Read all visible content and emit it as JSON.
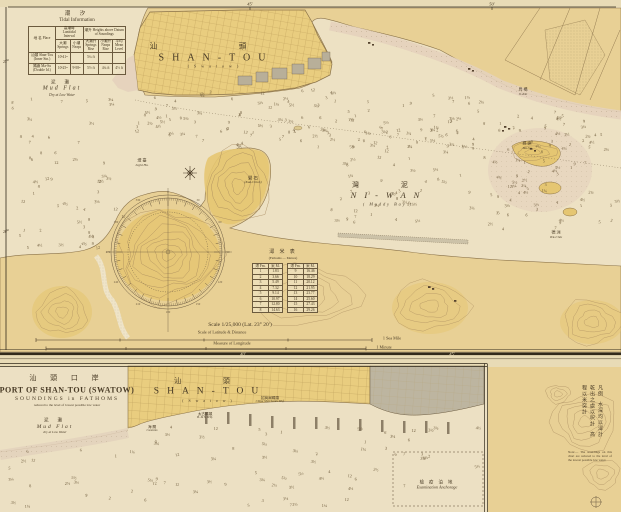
{
  "chart_title": "PORT OF SHAN-TOU (SWATOW)",
  "colors": {
    "paper": "#e8dbb6",
    "water": "#ede1c3",
    "land": "#e8d095",
    "city": "#e9cd7f",
    "hills": "#e5c672",
    "gray_block": "#b8af99",
    "tidal_flat": "#e5d3be",
    "ink": "#4a3b26",
    "contour": "#a88b5c",
    "border": "#332b1c"
  },
  "main_chart": {
    "top_ticks": [
      "45′",
      "50′"
    ],
    "left_ticks": [
      "25′",
      "20′"
    ],
    "bottom_ticks": [
      "40′",
      "45′"
    ],
    "tidal_table": {
      "title_cn": "潮 汐",
      "title_en": "Tidal Information",
      "name_header": "地 名 Place",
      "group1": "高潮時 Lunitidal Interval",
      "group2": "潮升 Heights above Datum of Soundings",
      "sub_headers": [
        "大潮 Springs",
        "小潮 Neaps",
        "大潮升 Springs Rise",
        "小潮升 Neaps Rise",
        "平均 Mean Level"
      ],
      "rows": [
        [
          "汕頭 Shan-Tou (Inner Stn.)",
          "10ʰ41ᵐ",
          "",
          "5¼ ft",
          "",
          ""
        ],
        [
          "媽嶼 Ma-Su (Double Id.)",
          "10ʰ25ᵐ",
          "9ʰ58ᵐ",
          "5½ ft",
          "4¼ ft",
          "4½ ft"
        ]
      ]
    },
    "labels": {
      "mud_flat": {
        "cn": "泥 灘",
        "en": "Mud Flat",
        "sub": "Dry at Low Water"
      },
      "city": {
        "cn": "汕  頭",
        "en": "SHAN-TOU",
        "sub": "( S w a t o w )"
      },
      "niwan": {
        "cn": "灣  泥",
        "en": "NI-WAN",
        "sub": "( Muddy  Bay )"
      },
      "lighthouse": {
        "cn": "燈 臺",
        "en": "Light Ho."
      },
      "kakchioh": {
        "cn": "礐 石",
        "en": "(Kak-Chioh)"
      },
      "masu": {
        "cn": "媽 嶼",
        "en": "Ma-Su"
      },
      "tekchiu": {
        "cn": "德 洲",
        "en": "Tek-Chiu"
      },
      "okio": {
        "cn": "烏 橋",
        "en": "O-Kio"
      }
    },
    "conversion_table": {
      "title_cn": "潯 米 表",
      "title_en": "(Fathoms — Metres)",
      "headers": [
        "潯 Fm.",
        "米 M."
      ],
      "left_rows": [
        [
          "1",
          "1.83"
        ],
        [
          "2",
          "3.66"
        ],
        [
          "3",
          "5.49"
        ],
        [
          "4",
          "7.32"
        ],
        [
          "5",
          "9.14"
        ],
        [
          "6",
          "10.97"
        ],
        [
          "7",
          "12.80"
        ],
        [
          "8",
          "14.63"
        ]
      ],
      "right_rows": [
        [
          "9",
          "16.46"
        ],
        [
          "10",
          "18.29"
        ],
        [
          "11",
          "20.12"
        ],
        [
          "12",
          "21.95"
        ],
        [
          "13",
          "23.77"
        ],
        [
          "14",
          "25.60"
        ],
        [
          "15",
          "27.43"
        ],
        [
          "16",
          "29.26"
        ]
      ]
    },
    "scale": {
      "note": "Scale 1/25,000  (Lat. 23° 20′)",
      "bar1_label": "Scale of Latitude & Distance",
      "bar1_end": "1 Sea Mile",
      "bar2_label": "Measure of Longitude",
      "bar2_end": "1 Minute"
    }
  },
  "inset": {
    "title_cn": "汕 頭 口 岸",
    "title_en": "PORT OF SHAN-TOU (SWATOW)",
    "sub1": "SOUNDINGS in FATHOMS",
    "sub2": "reduced to the level of lowest possible low water",
    "mud_flat": {
      "cn": "泥 灘",
      "en": "Mud Flat",
      "sub": "dry at Low Water"
    },
    "city": {
      "cn": "汕  頭",
      "en": "SHAN-TOU",
      "sub": "( S w a t o w )"
    },
    "pier1": {
      "cn": "招商局碼頭",
      "en": "China Merchants Whf."
    },
    "pier2": {
      "cn": "太古碼頭",
      "en": "B. & S. Whf."
    },
    "pier3": {
      "cn": "海 關",
      "en": "Customs"
    },
    "anchorage": {
      "cn": "檢 疫 泊 地",
      "en": "Examination Anchorage"
    }
  },
  "side_note": {
    "col1": "凡例",
    "col2": "水深均以潯計",
    "col3": "乾出之處以呎計",
    "col4": "高程以米突計",
    "en": "Note:— The soundings on this chart are reduced to the level of the lowest possible low water."
  },
  "soundings": {
    "values": [
      "1",
      "1¼",
      "2",
      "2½",
      "3",
      "3¼",
      "3½",
      "4",
      "4½",
      "5",
      "5½",
      "6",
      "7",
      "8",
      "9",
      "12"
    ]
  }
}
